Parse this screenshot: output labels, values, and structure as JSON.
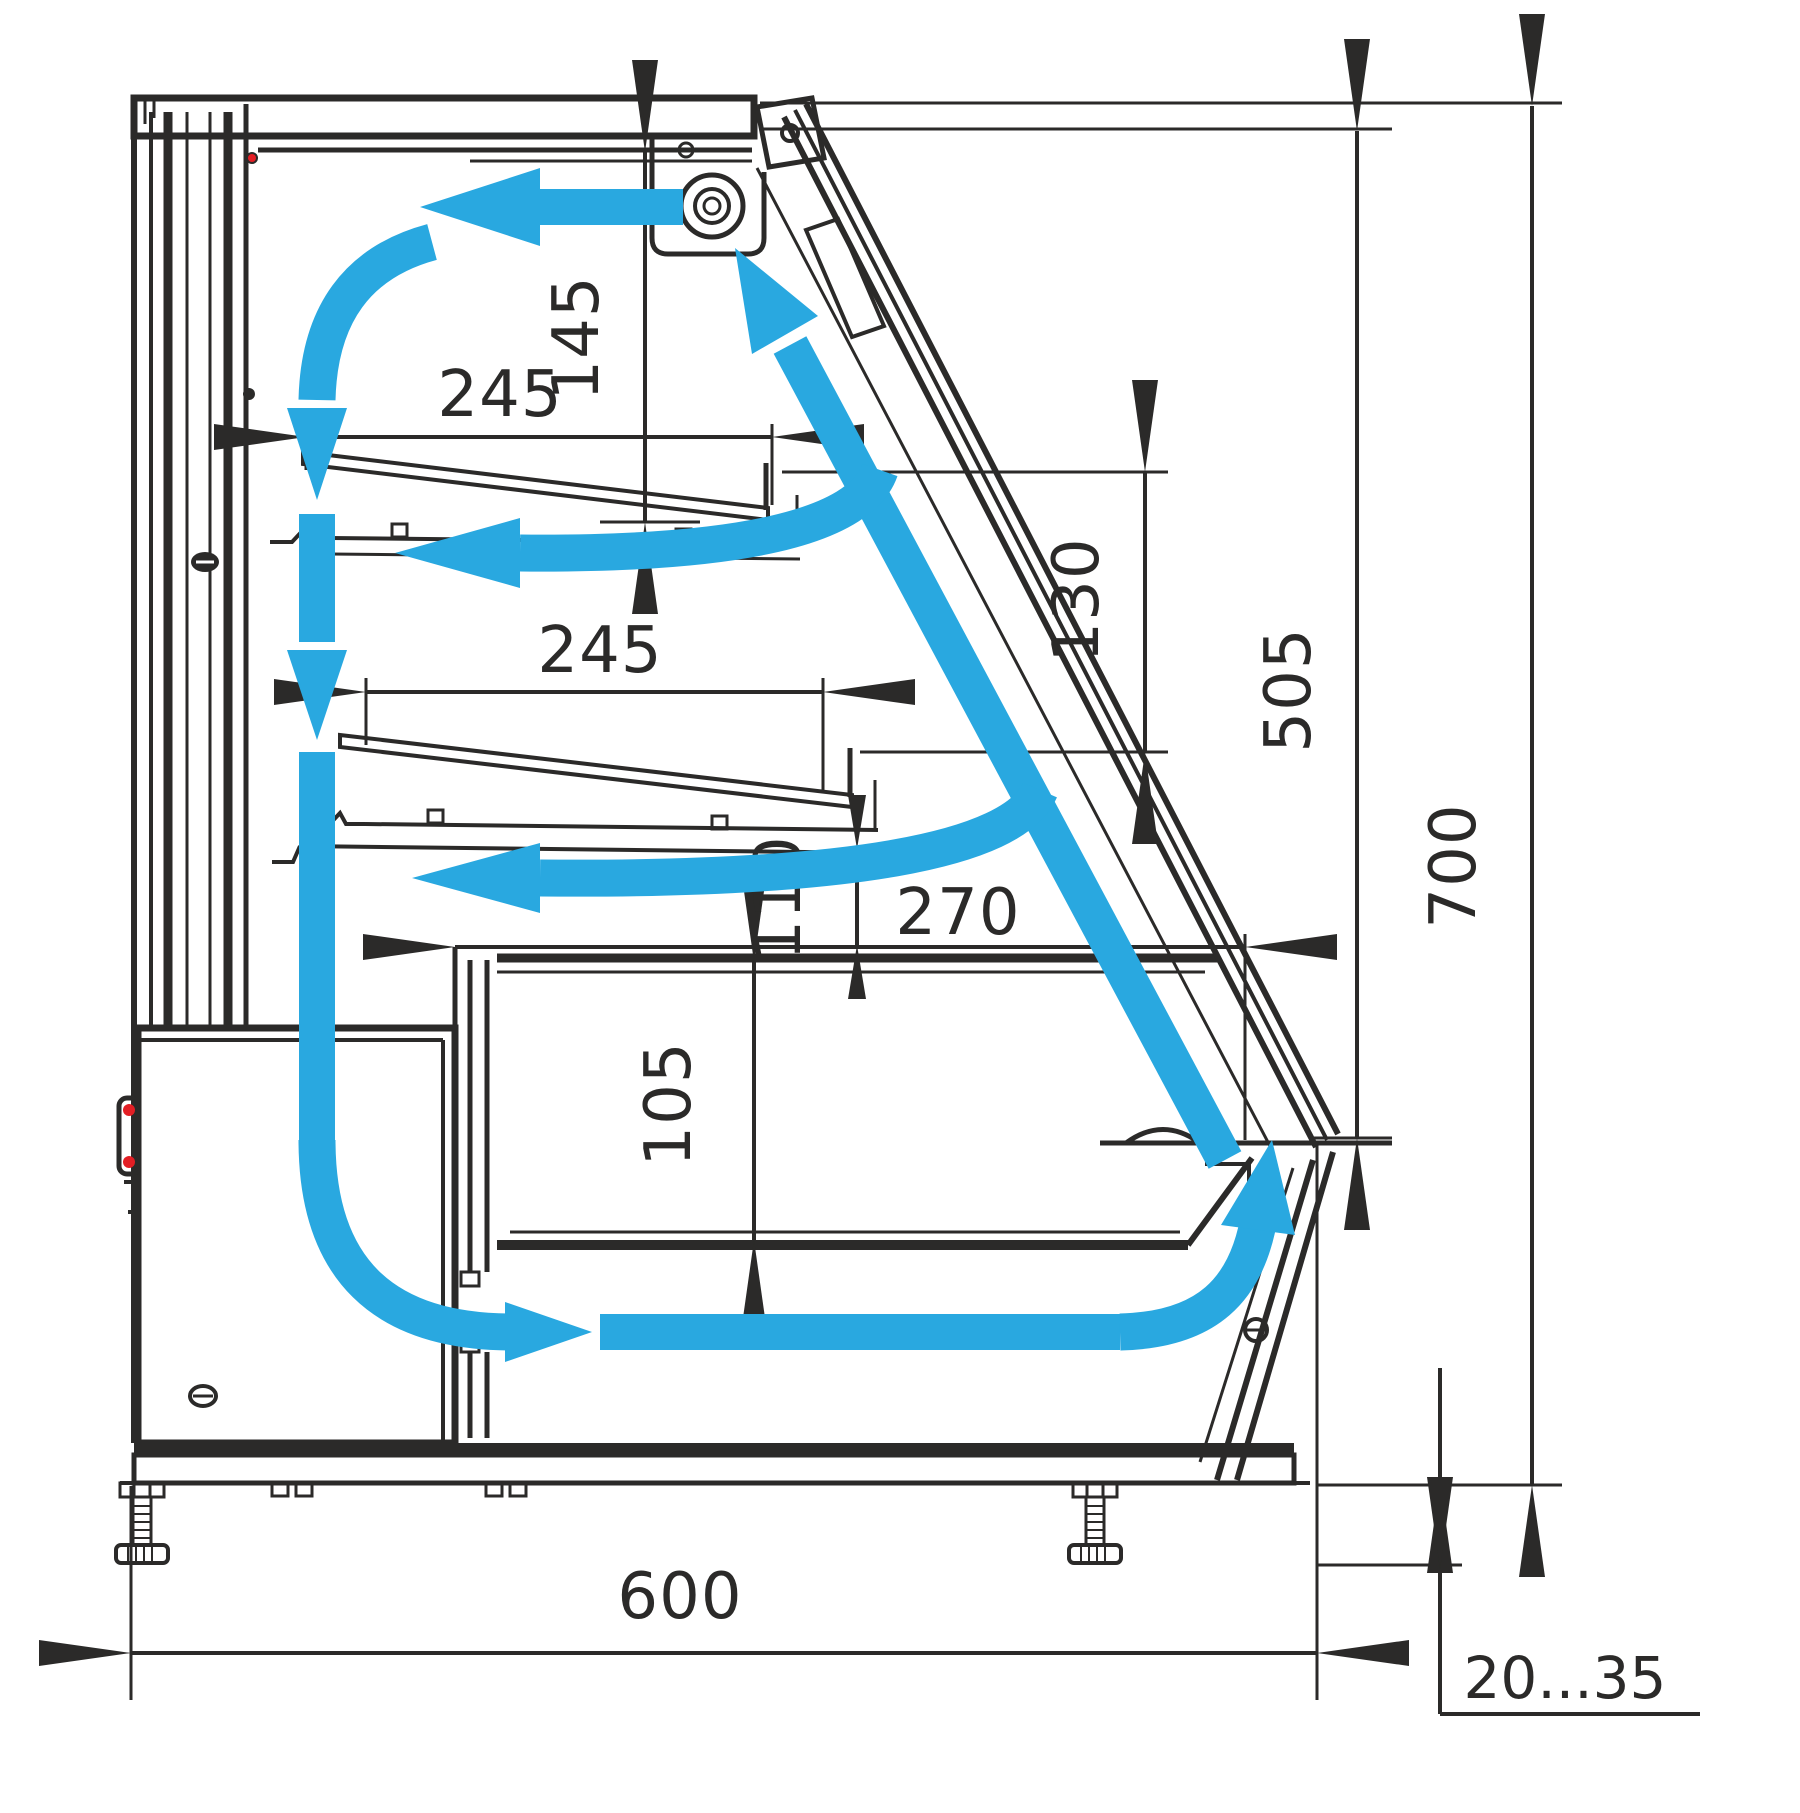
{
  "diagram": {
    "description": "Side cross-section technical drawing of a refrigerated confectionery display case showing internal air circulation",
    "units": "mm",
    "colors": {
      "line": "#2b2a29",
      "airflow_blue": "#29a8e0",
      "accent_red": "#e31e24",
      "background": "#ffffff"
    },
    "dimensions": {
      "top_shelf_depth": "245",
      "canopy_to_top_shelf": "145",
      "middle_shelf_depth": "245",
      "shelf_front_gap": "130",
      "front_glass_opening_height": "505",
      "overall_height": "700",
      "deck_to_counter_gap": "110",
      "well_depth_front": "270",
      "well_inner_height": "105",
      "overall_depth": "600",
      "leg_height_adjust_range": "20...35"
    },
    "airflow_arrows": [
      "ceiling-flow-left-from-fan",
      "back-wall-downflow-with-two-arrowheads",
      "bottom-turn-into-duct",
      "bottom-duct-flow-right",
      "front-riser-turn-up",
      "front-glass-upflow-to-fan",
      "upper-shelf-return-flow-left",
      "lower-shelf-return-flow-left"
    ],
    "components": [
      "canopy",
      "fan-unit",
      "back-panel",
      "upper-shelf",
      "lower-shelf",
      "display-deck",
      "well-floor",
      "rear-air-duct",
      "slanted-front-glass",
      "front-lower-panel",
      "machinery-compartment",
      "base-frame",
      "adjustable-feet"
    ]
  }
}
